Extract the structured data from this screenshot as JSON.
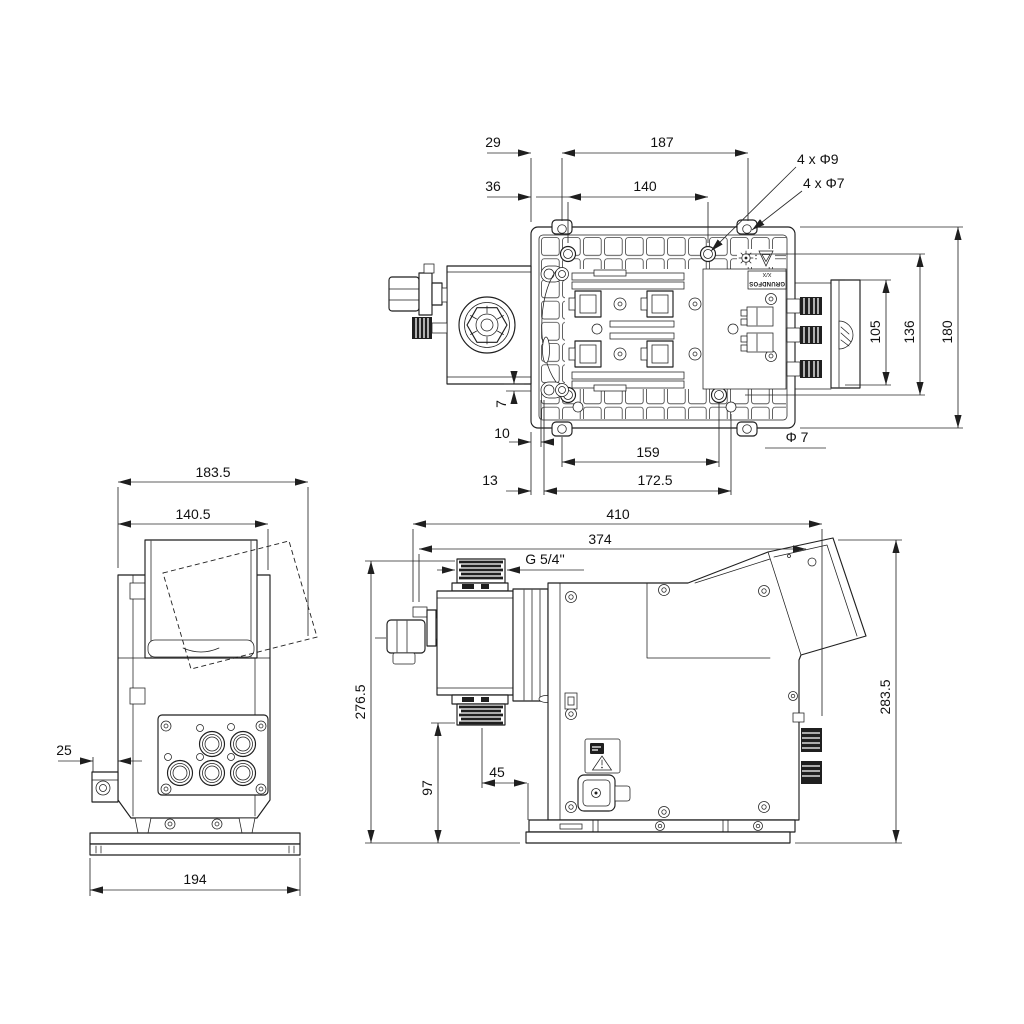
{
  "drawing": {
    "background": "#ffffff",
    "line_color": "#1f1f1f",
    "views": {
      "top": {
        "dims": {
          "offset_29": "29",
          "span_187": "187",
          "offset_36": "36",
          "span_140": "140",
          "holes_phi9": "4 x Φ9",
          "holes_phi7": "4 x Φ7",
          "height_105": "105",
          "height_136": "136",
          "height_180": "180",
          "offset_7": "7",
          "offset_10": "10",
          "span_159": "159",
          "phi_7": "Φ 7",
          "offset_13": "13",
          "span_172_5": "172.5"
        },
        "plate_label": {
          "variant": "X/X",
          "brand": "GRUNDFOS"
        },
        "symbols": [
          "gear-symbol",
          "warning-triangle-symbol"
        ]
      },
      "back": {
        "dims": {
          "width_183_5": "183.5",
          "width_140_5": "140.5",
          "offset_25": "25",
          "base_194": "194"
        }
      },
      "side": {
        "dims": {
          "length_410": "410",
          "length_374": "374",
          "thread_g54": "G 5/4''",
          "height_276_5": "276.5",
          "height_283_5": "283.5",
          "height_97": "97",
          "offset_45": "45"
        },
        "symbols": [
          "instruction-symbol",
          "warning-triangle-symbol"
        ]
      }
    }
  }
}
